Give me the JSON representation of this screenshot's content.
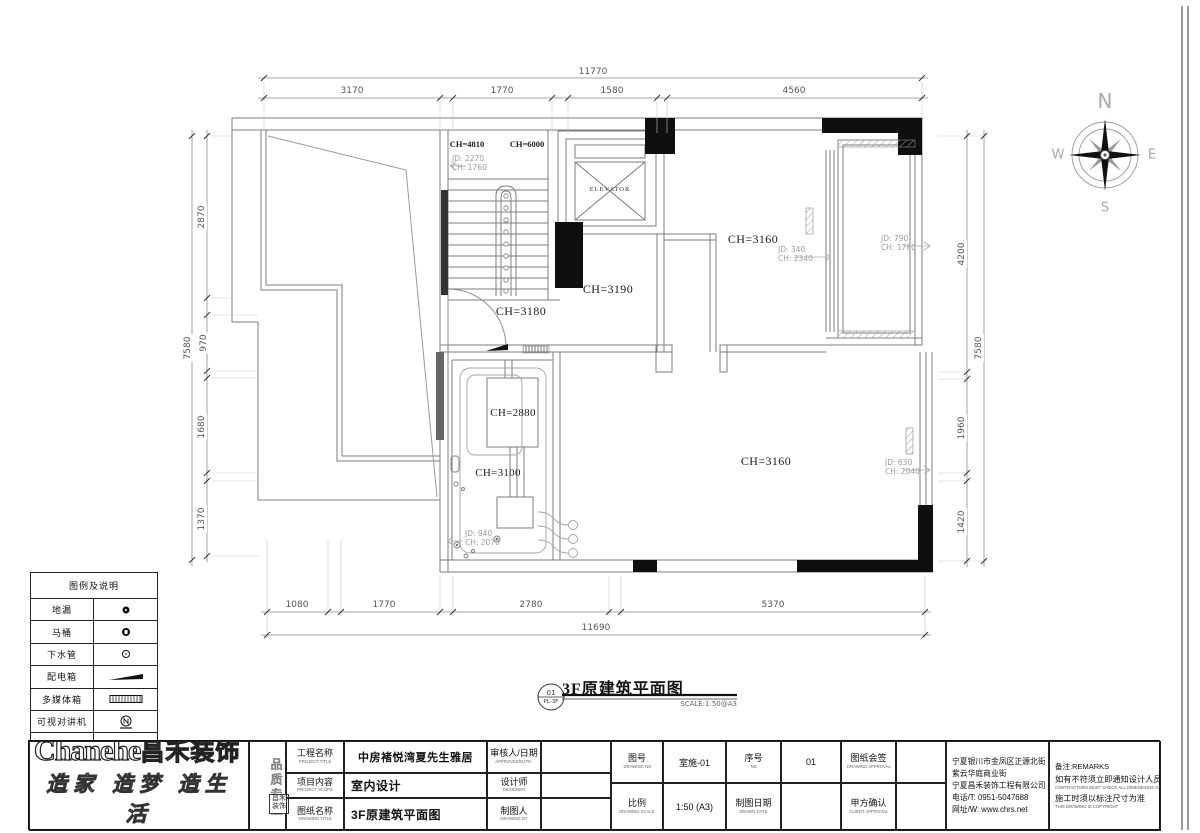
{
  "plan_labels": {
    "elevator": "ELEVATOR",
    "ch4810": "CH=4810",
    "ch6000": "CH=6000",
    "jd_stair_l1": "JD: 2270",
    "jd_stair_l2": "CH: 1760",
    "ch3180": "CH=3180",
    "ch3190": "CH=3190",
    "ch3160_top": "CH=3160",
    "jd340_l1": "JD: 340",
    "jd340_l2": "CH: 2340",
    "jd790_l1": "JD: 790",
    "jd790_l2": "CH: 1780",
    "ch2880": "CH=2880",
    "ch3100": "CH=3100",
    "jd940_l1": "JD: 940",
    "jd940_l2": "CH: 2070",
    "ch3160_bottom": "CH=3160",
    "jd630_l1": "JD: 630",
    "jd630_l2": "CH: 2040"
  },
  "dims": {
    "top": {
      "overall": "11770",
      "segments": [
        "3170",
        "1770",
        "1580",
        "4560"
      ]
    },
    "bottom": {
      "overall": "11690",
      "segments": [
        "1080",
        "1770",
        "2780",
        "5370"
      ]
    },
    "left": {
      "overall": "7580",
      "segments": [
        "2870",
        "970",
        "1680",
        "1370"
      ]
    },
    "right": {
      "overall": "7580",
      "segments": [
        "4200",
        "1960",
        "1420"
      ]
    }
  },
  "compass": {
    "n": "N",
    "e": "E",
    "s": "S",
    "w": "W"
  },
  "drawing_title": {
    "number": "01",
    "code": "PL-3F",
    "title": "3F原建筑平面图",
    "scale": "SCALE:1:50@A3"
  },
  "legend": {
    "title": "图例及说明",
    "items": [
      {
        "label": "地漏",
        "symbol": "floor-drain"
      },
      {
        "label": "马桶",
        "symbol": "toilet"
      },
      {
        "label": "下水管",
        "symbol": "drain-pipe"
      },
      {
        "label": "配电箱",
        "symbol": "distribution-box"
      },
      {
        "label": "多媒体箱",
        "symbol": "multimedia-box"
      },
      {
        "label": "可视对讲机",
        "symbol": "video-intercom"
      },
      {
        "label": "分水器",
        "symbol": "water-manifold"
      }
    ]
  },
  "titleblock": {
    "logo_en": "Chanehe",
    "logo_cn": "昌禾装饰",
    "slogan": "造家 造梦 造生活",
    "tagline_vertical": "品质专注",
    "seal": "昌禾装饰",
    "fields": {
      "project_title_label": "工程名称",
      "project_title_en": "PROJECT TITLE",
      "project_title_value": "中房褚悦湾夏先生雅居",
      "project_scope_label": "项目内容",
      "project_scope_en": "PROJECT SCOPE",
      "project_scope_value": "室内设计",
      "drawing_title_label": "图纸名称",
      "drawing_title_en": "DRAWING TITLE",
      "drawing_title_value": "3F原建筑平面图",
      "approved_label": "审核人/日期",
      "approved_en": "APPROVED/DATE:",
      "designer_label": "设计师",
      "designer_en": "DESIGNER",
      "drawn_by_label": "制图人",
      "drawn_by_en": "DRAWING BY",
      "drawing_no_label": "图号",
      "drawing_no_en": "DRAWING NO",
      "drawing_no_value": "室施-01",
      "no_label": "序号",
      "no_en": "NO",
      "no_value": "01",
      "drawing_approval_label": "图纸会签",
      "drawing_approval_en": "DRAWING APPROVAL",
      "scale_label": "比例",
      "scale_en": "DRAWING SCALE",
      "scale_value": "1:50 (A3)",
      "date_label": "制图日期",
      "date_en": "DRAWN DATE",
      "client_label": "甲方确认",
      "client_en": "CLIENT APPROVAL"
    },
    "company": [
      "宁夏银川市金凤区正源北街",
      "紫云华庭商业街",
      "宁夏昌禾装饰工程有限公司",
      "电话/T: 0951-5047688",
      "网址/W: www.chrs.net"
    ],
    "remarks": {
      "title": "备注:REMARKS",
      "line1_cn": "如有不符须立即通知设计人员",
      "line1_en": "CONTRACTORS MUST CHECK ALL DIMENSIONS ON SITE",
      "line2_cn": "施工时须以标注尺寸为准",
      "line2_en": "THIS DRAWING IS COPYRIGHT"
    }
  }
}
